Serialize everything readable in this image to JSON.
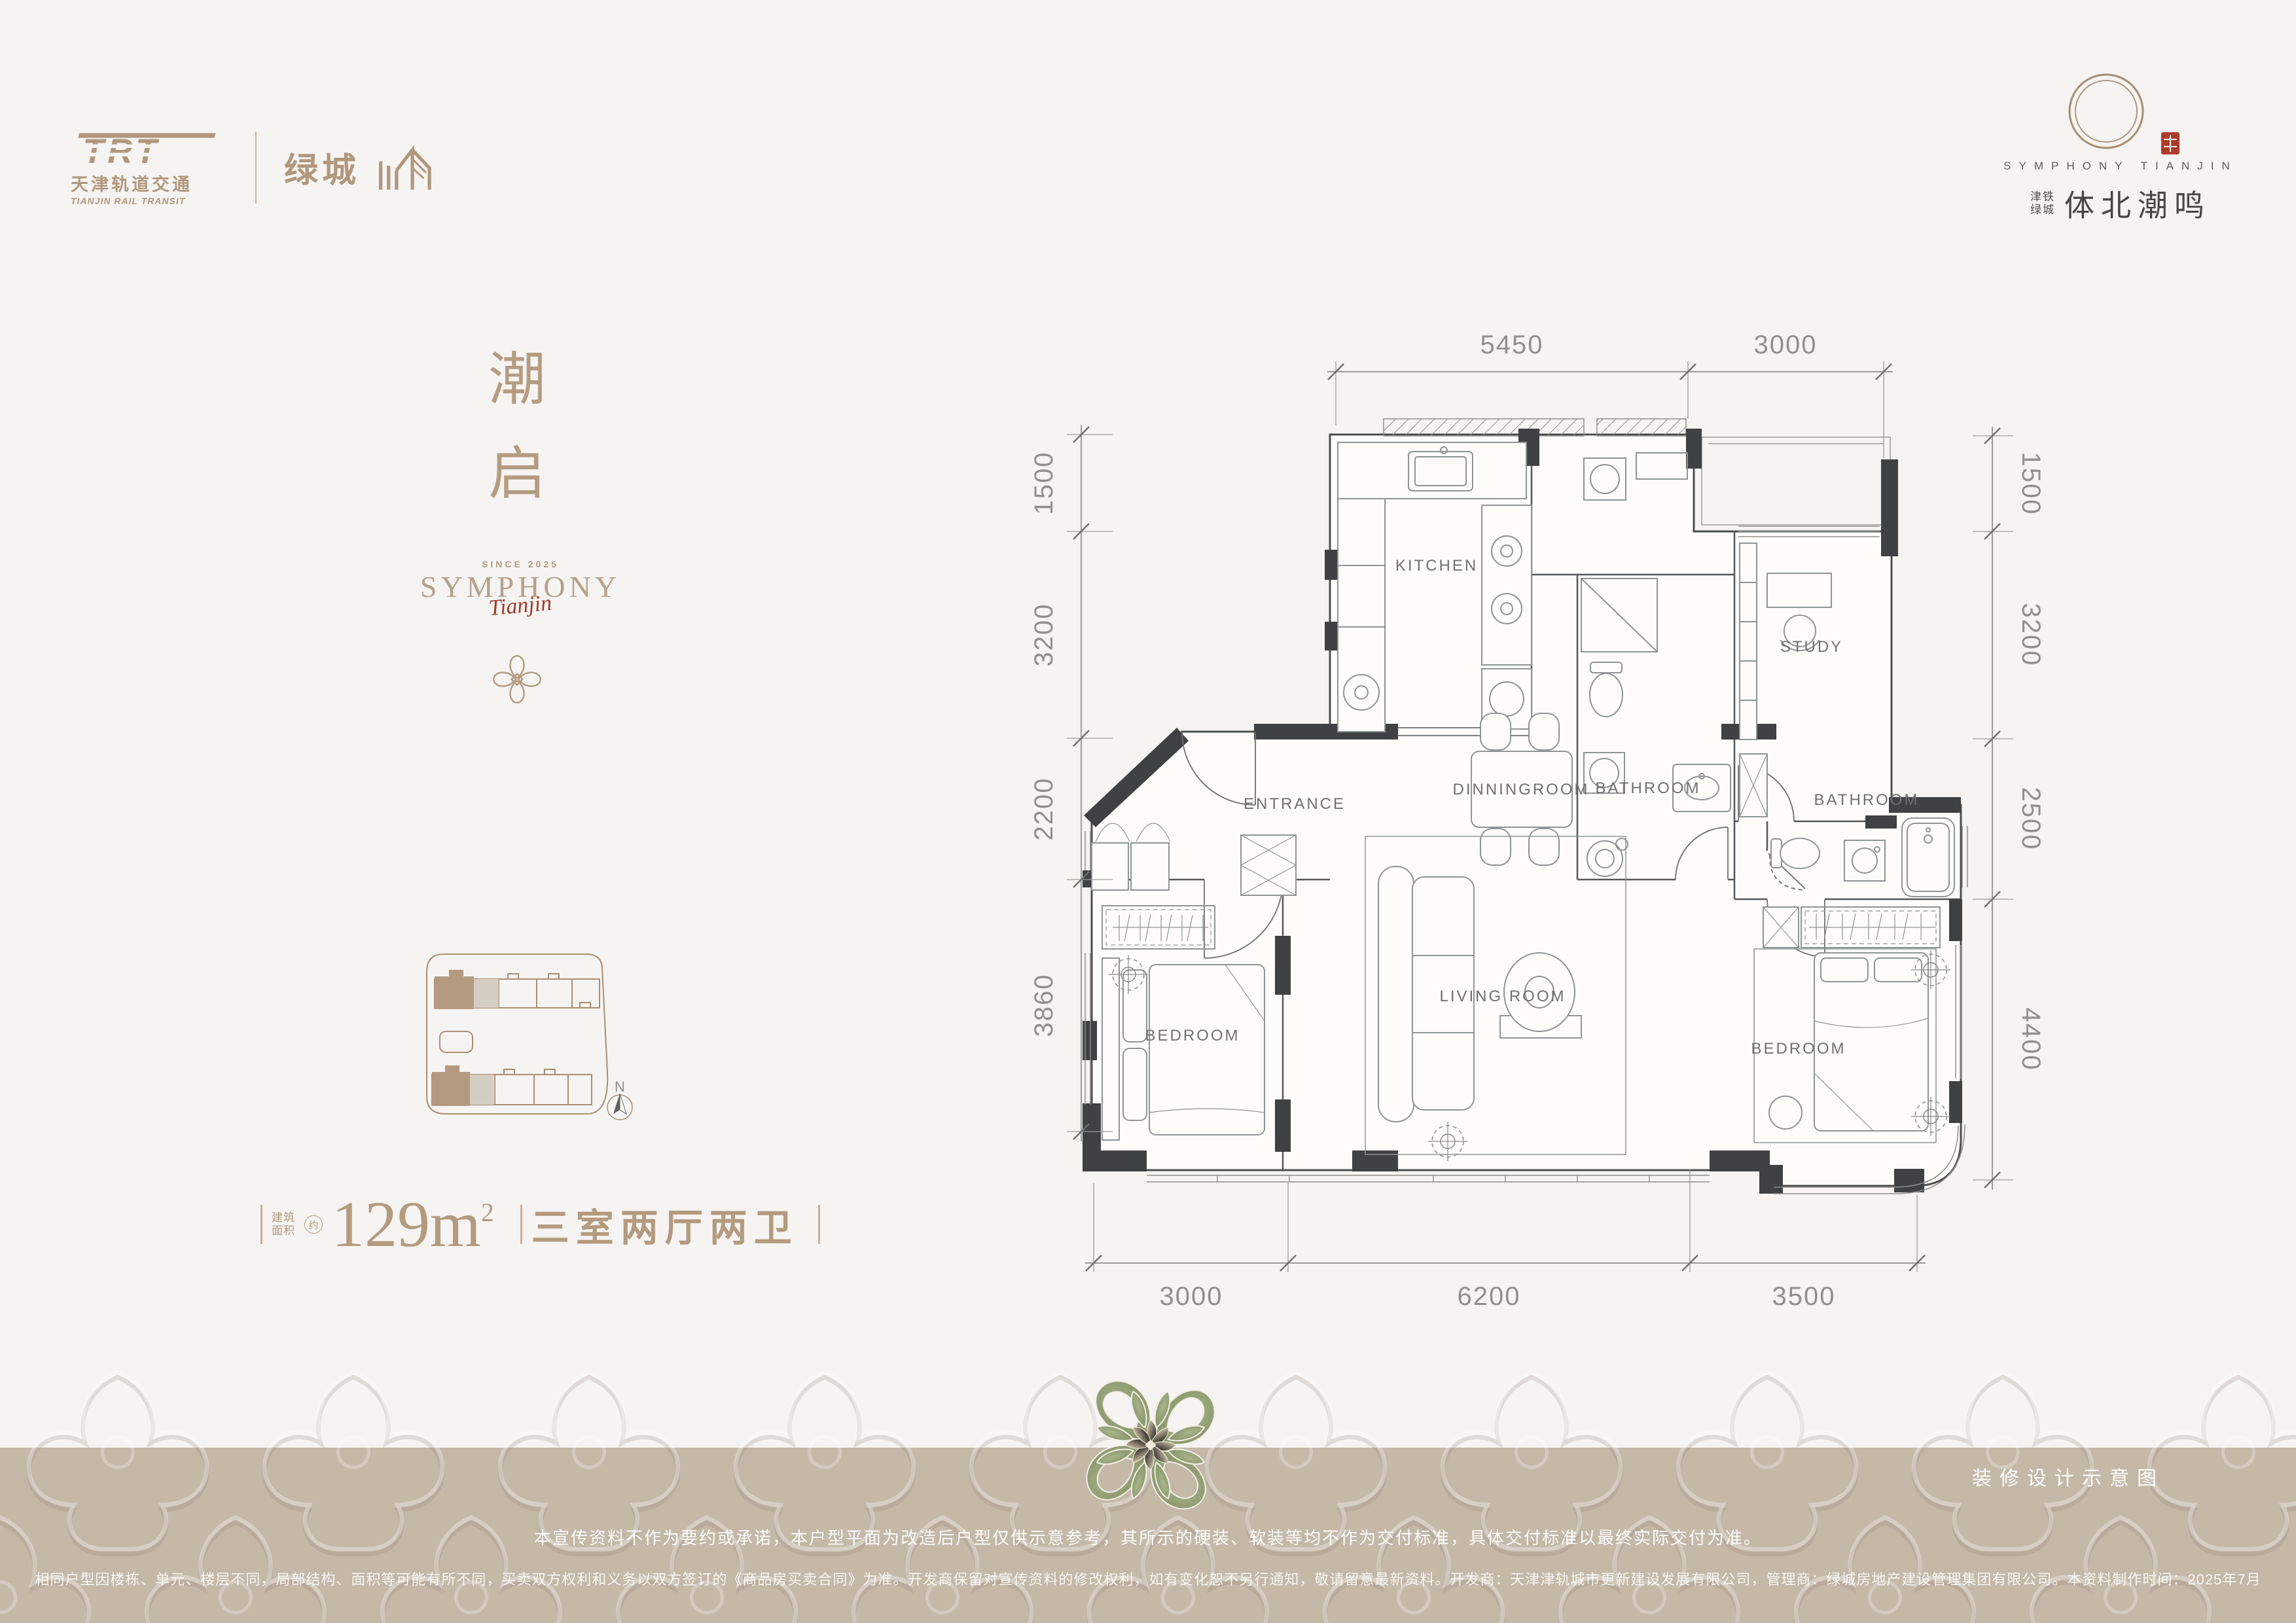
{
  "colors": {
    "background": "#f6f4f2",
    "accent_tan": "#b1977c",
    "band": "#c4b8a7",
    "seal_red": "#ad3b2a",
    "title_gray": "#5e5e5e",
    "plan_line": "#6f6f6f",
    "ornament_green": "#93a077"
  },
  "header_left": {
    "trt_acronym": "TRT",
    "trt_cn": "天津轨道交通",
    "trt_en": "TIANJIN RAIL TRANSIT",
    "greentown_cn": "绿城"
  },
  "header_right": {
    "title_en": "SYMPHONY TIANJIN",
    "sub_cn_line1": "津铁",
    "sub_cn_line2": "绿城",
    "title_cn": "体北潮鸣"
  },
  "left_panel": {
    "slogan_top": "潮",
    "slogan_bottom": "启",
    "since": "SINCE 2025",
    "brand": "SYMPHONY",
    "brand_script": "Tianjin",
    "north_label": "N",
    "area_label_line1": "建筑",
    "area_label_line2": "面积",
    "area_approx": "约",
    "area_value": "129m",
    "area_sup": "2",
    "layout_text": "三室两厅两卫"
  },
  "plan": {
    "rooms": [
      "KITCHEN",
      "DINNINGROOM",
      "BATHROOM",
      "STUDY",
      "ENTRANCE",
      "LIVING ROOM",
      "BEDROOM",
      "BATHROOM",
      "BEDROOM"
    ],
    "dims_top": [
      "5450",
      "3000"
    ],
    "dims_left": [
      "1500",
      "3200",
      "2200",
      "3860"
    ],
    "dims_right": [
      "1500",
      "3200",
      "2500",
      "4400"
    ],
    "dims_bottom": [
      "3000",
      "6200",
      "3500"
    ]
  },
  "footer": {
    "caption": "装修设计示意图",
    "disclaimer_line1": "本宣传资料不作为要约或承诺，本户型平面为改造后户型仅供示意参考，其所示的硬装、软装等均不作为交付标准，具体交付标准以最终实际交付为准。",
    "disclaimer_line2": "相同户型因楼栋、单元、楼层不同，局部结构、面积等可能有所不同，买卖双方权利和义务以双方签订的《商品房买卖合同》为准。开发商保留对宣传资料的修改权利，如有变化恕不另行通知，敬请留意最新资料。开发商：天津津轨城市更新建设发展有限公司，管理商：绿城房地产建设管理集团有限公司。本资料制作时间：2025年7月"
  }
}
